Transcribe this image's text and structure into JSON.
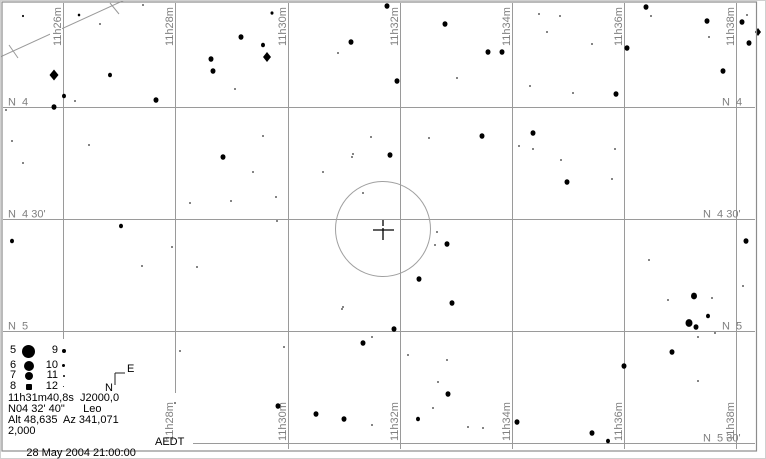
{
  "app": {
    "description": "Star chart view (planetarium application)"
  },
  "grid": {
    "line_color": "#9a9a9a",
    "label_color": "#808080",
    "circle_color": "#a0a0a0",
    "star_color": "#000000",
    "ra_lines": [
      {
        "x": 63,
        "label": "11h26m",
        "top_label": true,
        "bottom_label": false
      },
      {
        "x": 175,
        "label": "11h28m",
        "top_label": true,
        "bottom_label": true
      },
      {
        "x": 288,
        "label": "11h30m",
        "top_label": true,
        "bottom_label": true
      },
      {
        "x": 400,
        "label": "11h32m",
        "top_label": true,
        "bottom_label": true
      },
      {
        "x": 512,
        "label": "11h34m",
        "top_label": true,
        "bottom_label": true
      },
      {
        "x": 624,
        "label": "11h36m",
        "top_label": true,
        "bottom_label": true
      },
      {
        "x": 736,
        "label": "11h38m",
        "top_label": true,
        "bottom_label": true
      }
    ],
    "dec_lines": [
      {
        "y": 107.5,
        "label": "N  4",
        "left": true,
        "right": true
      },
      {
        "y": 219.5,
        "label": "N  4 30'",
        "left": true,
        "right": true
      },
      {
        "y": 331.5,
        "label": "N  5",
        "left": true,
        "right": true
      },
      {
        "y": 443.5,
        "label": "N  5 30'",
        "left": false,
        "right": true
      }
    ]
  },
  "ecliptic": {
    "x1": -2,
    "y1": 58,
    "x2": 129,
    "y2": -2,
    "ticks": [
      {
        "x1": 9,
        "y1": 45,
        "x2": 18,
        "y2": 58
      },
      {
        "x1": 110,
        "y1": 3,
        "x2": 119,
        "y2": 14
      }
    ]
  },
  "field_circle": {
    "cx": 383,
    "cy": 229,
    "r": 47.5
  },
  "crosshair": {
    "x": 383,
    "y": 230
  },
  "compass": {
    "corner": [
      115,
      373
    ],
    "east_end": [
      124,
      373
    ],
    "north_end": [
      115,
      385
    ],
    "east_label": "E",
    "north_label": "N"
  },
  "stars": [
    [
      23,
      16,
      2
    ],
    [
      79,
      15,
      2.5
    ],
    [
      100,
      24,
      1.5
    ],
    [
      143,
      5,
      1.5
    ],
    [
      241,
      37,
      5
    ],
    [
      211,
      59,
      5
    ],
    [
      213,
      71,
      5
    ],
    [
      110,
      75,
      4
    ],
    [
      64,
      96,
      4
    ],
    [
      54,
      107,
      5
    ],
    [
      156,
      100,
      5
    ],
    [
      75,
      101,
      1.5
    ],
    [
      235,
      89,
      1.5
    ],
    [
      6,
      110,
      1.5
    ],
    [
      12,
      141,
      1.5
    ],
    [
      89,
      145,
      1.5
    ],
    [
      23,
      163,
      1.5
    ],
    [
      12,
      241,
      4
    ],
    [
      121,
      226,
      4
    ],
    [
      272,
      13,
      3
    ],
    [
      387,
      6,
      5
    ],
    [
      263,
      45,
      4
    ],
    [
      351,
      42,
      5
    ],
    [
      338,
      53,
      1.5
    ],
    [
      397,
      81,
      5
    ],
    [
      445,
      24,
      5
    ],
    [
      488,
      52,
      5
    ],
    [
      502,
      52,
      5
    ],
    [
      457,
      78,
      1.5
    ],
    [
      263,
      136,
      1.5
    ],
    [
      371,
      137,
      1.5
    ],
    [
      482,
      136,
      5
    ],
    [
      429,
      138,
      1.5
    ],
    [
      539,
      14,
      1.5
    ],
    [
      560,
      16,
      1.5
    ],
    [
      547,
      32,
      1.5
    ],
    [
      646,
      7,
      5
    ],
    [
      651,
      16,
      1.5
    ],
    [
      707,
      21,
      5
    ],
    [
      709,
      37,
      1.5
    ],
    [
      742,
      22,
      5
    ],
    [
      749,
      43,
      5
    ],
    [
      747,
      15,
      1.5
    ],
    [
      627,
      48,
      5
    ],
    [
      592,
      44,
      1.5
    ],
    [
      723,
      71,
      5
    ],
    [
      530,
      86,
      1.5
    ],
    [
      573,
      93,
      1.5
    ],
    [
      616,
      94,
      5
    ],
    [
      533,
      133,
      5
    ],
    [
      519,
      146,
      1.5
    ],
    [
      533,
      149,
      1.5
    ],
    [
      615,
      149,
      1.5
    ],
    [
      223,
      157,
      5
    ],
    [
      253,
      172,
      1.5
    ],
    [
      323,
      172,
      1.5
    ],
    [
      353,
      154,
      1.5
    ],
    [
      190,
      203,
      1.5
    ],
    [
      231,
      201,
      1.5
    ],
    [
      276,
      197,
      1.5
    ],
    [
      363,
      193,
      1.5
    ],
    [
      277,
      221,
      1.5
    ],
    [
      172,
      247,
      1.5
    ],
    [
      142,
      266,
      1.5
    ],
    [
      197,
      267,
      1.5
    ],
    [
      343,
      307,
      1.5
    ],
    [
      390,
      155,
      5
    ],
    [
      352,
      157,
      1.5
    ],
    [
      437,
      232,
      1.5
    ],
    [
      447,
      244,
      5
    ],
    [
      435,
      245,
      1.5
    ],
    [
      419,
      279,
      5
    ],
    [
      452,
      303,
      5
    ],
    [
      567,
      182,
      5
    ],
    [
      612,
      179,
      1.5
    ],
    [
      561,
      160,
      1.5
    ],
    [
      649,
      260,
      1.5
    ],
    [
      624,
      366,
      5
    ],
    [
      746,
      241,
      5
    ],
    [
      694,
      296,
      6
    ],
    [
      708,
      316,
      4
    ],
    [
      689,
      323,
      7
    ],
    [
      696,
      327,
      5
    ],
    [
      668,
      300,
      1.5
    ],
    [
      712,
      298,
      1.5
    ],
    [
      715,
      333,
      1.5
    ],
    [
      698,
      337,
      1.5
    ],
    [
      672,
      352,
      5
    ],
    [
      698,
      381,
      1.5
    ],
    [
      743,
      286,
      1.5
    ],
    [
      342,
      309,
      1.5
    ],
    [
      394,
      329,
      5
    ],
    [
      363,
      343,
      5
    ],
    [
      372,
      337,
      1.5
    ],
    [
      284,
      347,
      1.5
    ],
    [
      408,
      355,
      1.5
    ],
    [
      447,
      360,
      1.5
    ],
    [
      438,
      382,
      1.5
    ],
    [
      448,
      394,
      5
    ],
    [
      278,
      406,
      5
    ],
    [
      316,
      414,
      5
    ],
    [
      344,
      419,
      5
    ],
    [
      433,
      408,
      1.5
    ],
    [
      418,
      419,
      4
    ],
    [
      372,
      425,
      1.5
    ],
    [
      468,
      427,
      1.5
    ],
    [
      483,
      428,
      1.5
    ],
    [
      517,
      422,
      5
    ],
    [
      175,
      403,
      1.5
    ],
    [
      592,
      433,
      5
    ],
    [
      608,
      441,
      4
    ],
    [
      180,
      351,
      1.5
    ]
  ],
  "diamond_stars": [
    [
      54,
      75,
      9
    ],
    [
      267,
      57,
      8
    ],
    [
      758,
      32,
      6
    ]
  ],
  "legend": {
    "x": 8,
    "y": 340,
    "rows": [
      {
        "mag": "5",
        "size": 13,
        "mag2": "9",
        "size2": 4
      },
      {
        "mag": "6",
        "size": 10,
        "mag2": "10",
        "size2": 3.5
      },
      {
        "mag": "7",
        "size": 8,
        "mag2": "11",
        "size2": 2
      },
      {
        "mag": "8",
        "size": 6,
        "mag2": "12",
        "size2": 1.5
      }
    ]
  },
  "status": {
    "lines": [
      "11h31m40,8s  J2000,0",
      "N04 32' 40\"      Leo",
      "Alt 48,635  Az 341,071",
      "2,000",
      "28 May 2004 21:00:00"
    ],
    "timezone": "AEDT"
  }
}
